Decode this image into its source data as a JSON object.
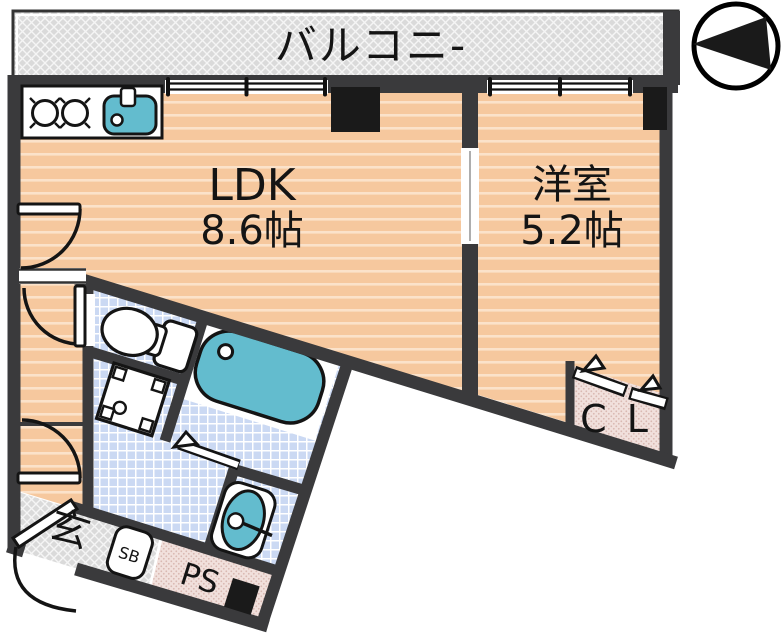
{
  "rooms": {
    "balcony": {
      "label": "バルコニ-"
    },
    "ldk": {
      "label": "LDK",
      "size": "8.6帖"
    },
    "western_room": {
      "label": "洋室",
      "size": "5.2帖"
    },
    "closet": {
      "label": "C L"
    },
    "entrance": {
      "label": "玄"
    },
    "shoe_box": {
      "label": "SB"
    },
    "pipe_space": {
      "label": "PS"
    }
  },
  "fixtures": {
    "kitchen_stove": "stove-burners-icon",
    "kitchen_sink": "sink-icon",
    "bathtub": "bathtub-icon",
    "toilet": "toilet-icon",
    "washing_machine_pan": "washing-machine-pan-icon",
    "washbasin": "washbasin-icon",
    "compass": "compass-north-left-icon"
  },
  "colors": {
    "floor_peach": "#F6C89E",
    "floor_stripe": "#FBE2CA",
    "wet_area_blue": "#CBD9F3",
    "fixture_teal": "#63BCCE",
    "balcony_gray": "#DADADA",
    "closet_pink": "#F1E0DC",
    "wall_dark": "#3A3A3C",
    "pillar_black": "#1A1A1A",
    "text": "#141414"
  }
}
